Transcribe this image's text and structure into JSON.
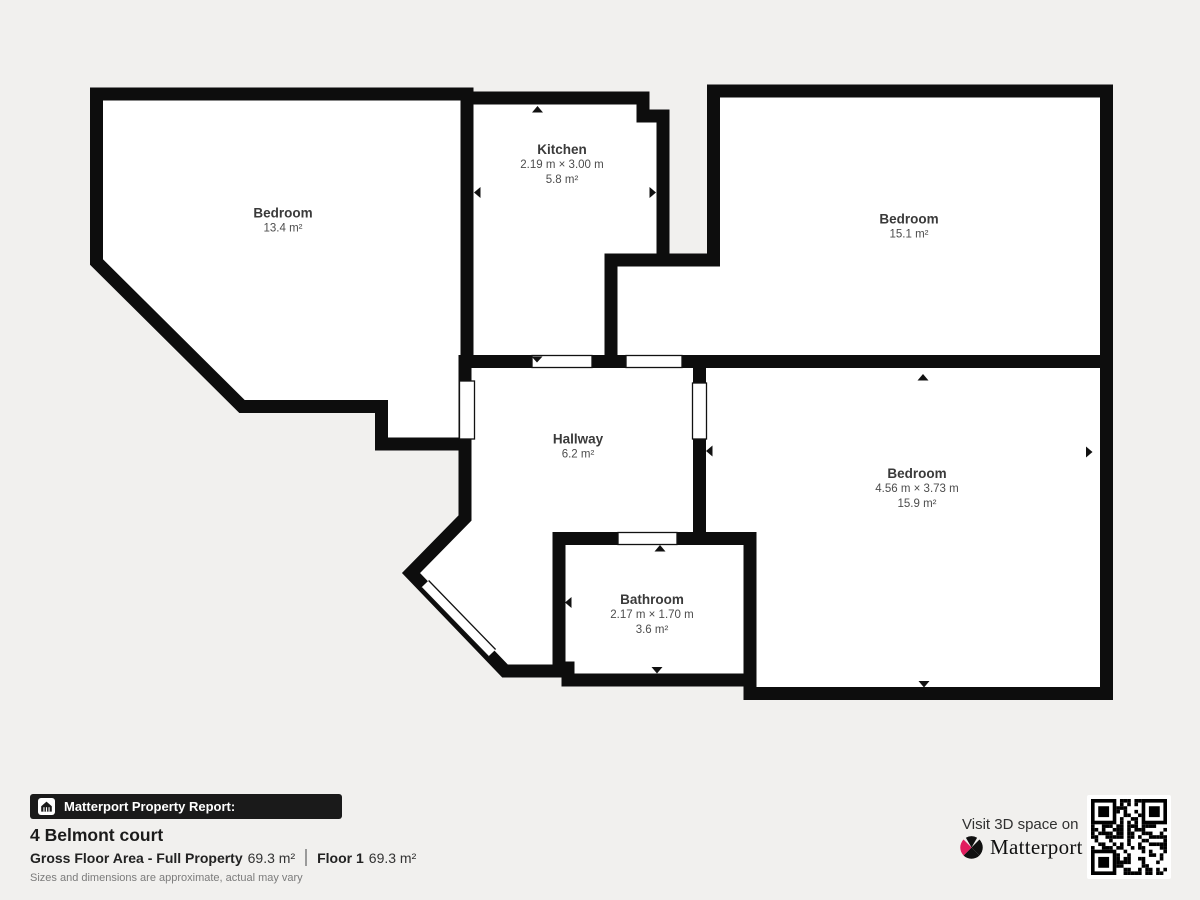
{
  "floorplan": {
    "rooms": [
      {
        "name": "Bedroom",
        "area": "13.4 m²"
      },
      {
        "name": "Kitchen",
        "dims": "2.19 m × 3.00 m",
        "area": "5.8 m²"
      },
      {
        "name": "Bedroom",
        "area": "15.1 m²"
      },
      {
        "name": "Hallway",
        "area": "6.2 m²"
      },
      {
        "name": "Bedroom",
        "dims": "4.56 m × 3.73 m",
        "area": "15.9 m²"
      },
      {
        "name": "Bathroom",
        "dims": "2.17 m × 1.70 m",
        "area": "3.6 m²"
      }
    ]
  },
  "report": {
    "badge_label": "Matterport Property Report:",
    "address": "4 Belmont court",
    "gfa_label": "Gross Floor Area - Full Property",
    "gfa_value": "69.3 m²",
    "floor_label": "Floor 1",
    "floor_value": "69.3 m²",
    "disclaimer": "Sizes and dimensions are approximate, actual may vary"
  },
  "promo": {
    "visit_text": "Visit 3D space on",
    "brand": "Matterport",
    "mark": "’"
  },
  "colors": {
    "background": "#f1f0ee",
    "wall": "#0d0d0d",
    "room_fill": "#ffffff",
    "badge_background": "#1a1a1a",
    "brand_pink": "#e11d5e"
  }
}
